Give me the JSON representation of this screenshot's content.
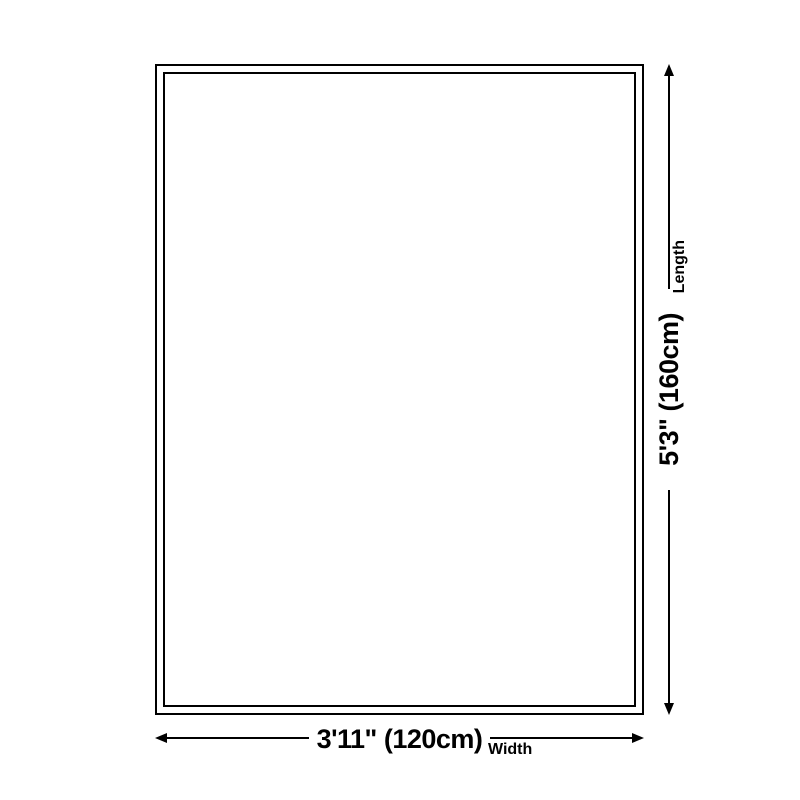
{
  "diagram": {
    "type": "product-dimension-diagram",
    "length": {
      "axis_label": "Length",
      "value": "5'3\" (160cm)"
    },
    "width": {
      "axis_label": "Width",
      "value": "3'11\" (120cm)"
    },
    "colors": {
      "line": "#000000",
      "background": "#ffffff"
    }
  }
}
